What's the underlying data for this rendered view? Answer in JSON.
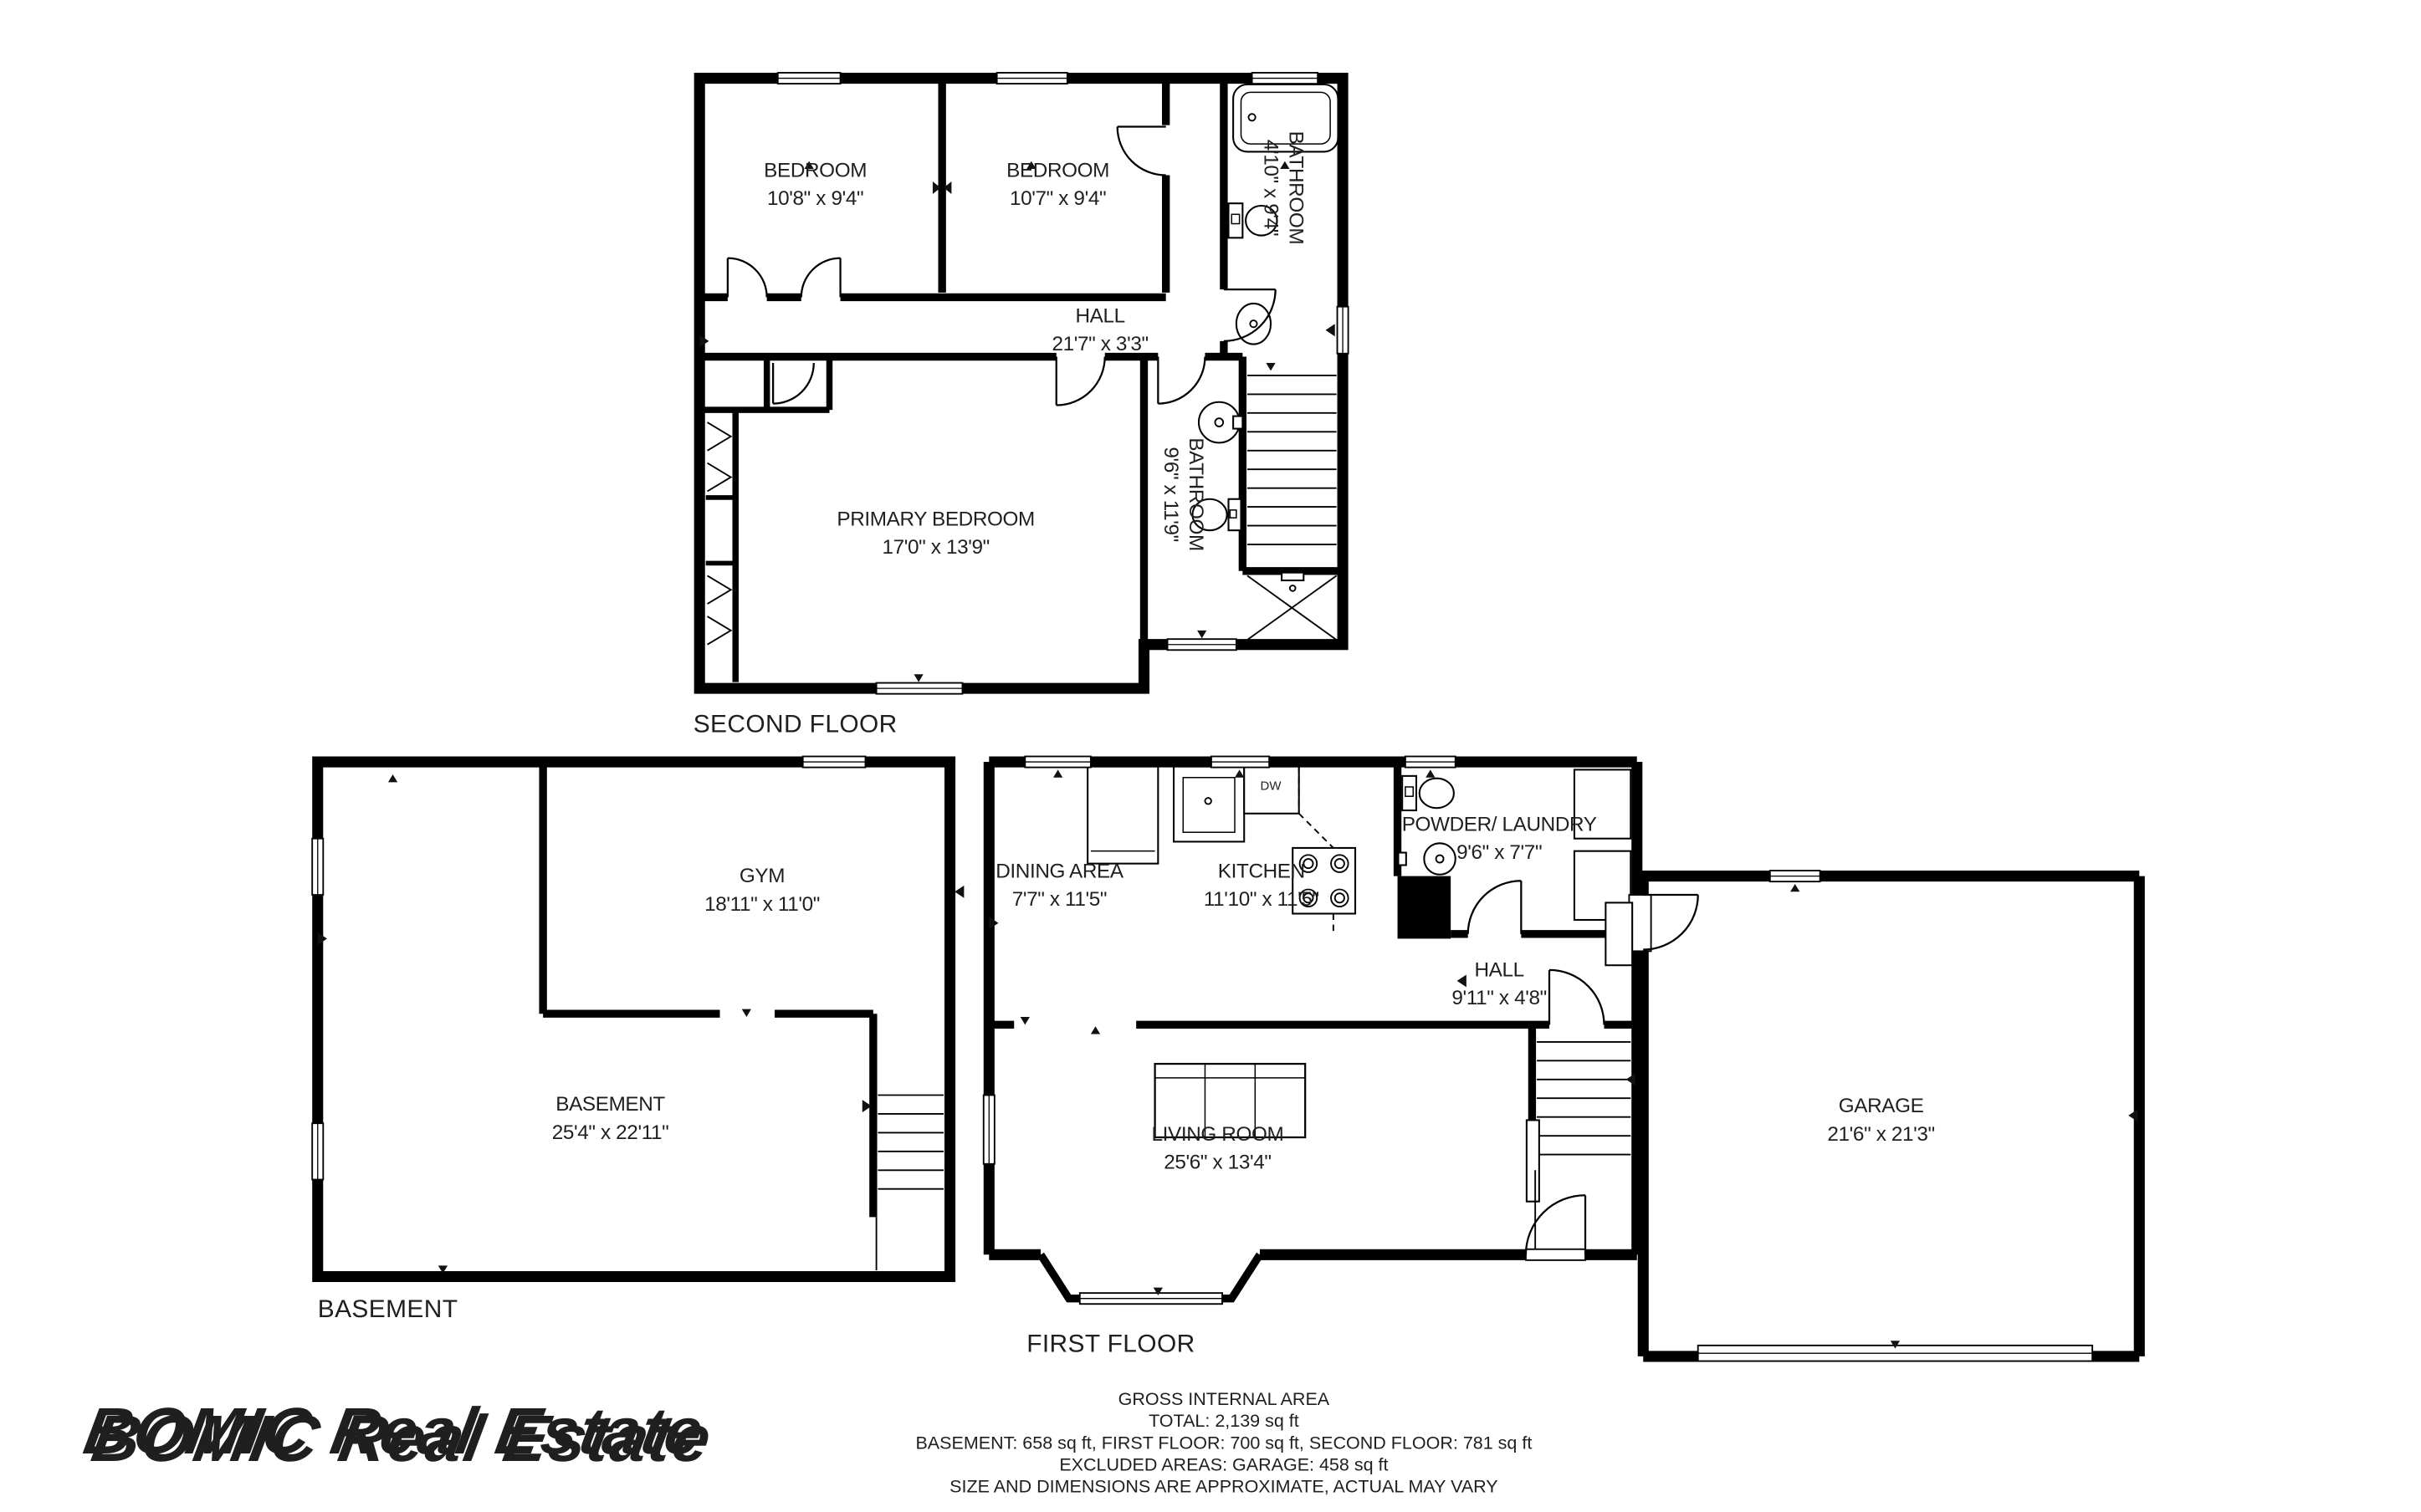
{
  "colors": {
    "wall": "#000000",
    "text": "#1f1f1f",
    "muted": "#a6a6a6",
    "watermark": "#c9c9c9",
    "watermark_highlight": "#ffffff"
  },
  "watermark": {
    "text": "BOMIC Real Estate"
  },
  "floors": {
    "second": {
      "title": "SECOND FLOOR",
      "rooms": {
        "bedroom_left": {
          "name": "BEDROOM",
          "dims": "10'8\" x 9'4\""
        },
        "bedroom_right": {
          "name": "BEDROOM",
          "dims": "10'7\" x 9'4\""
        },
        "bathroom_small": {
          "name": "BATHROOM",
          "dims": "4'10\" x 9'4\""
        },
        "hall": {
          "name": "HALL",
          "dims": "21'7\" x 3'3\""
        },
        "primary_bedroom": {
          "name": "PRIMARY BEDROOM",
          "dims": "17'0\" x 13'9\""
        },
        "bathroom_large": {
          "name": "BATHROOM",
          "dims": "9'6\" x 11'9\""
        }
      }
    },
    "first": {
      "title": "FIRST FLOOR",
      "appliances": {
        "dishwasher": "DW"
      },
      "rooms": {
        "dining_area": {
          "name": "DINING AREA",
          "dims": "7'7\" x 11'5\""
        },
        "kitchen": {
          "name": "KITCHEN",
          "dims": "11'10\" x 11'5\""
        },
        "powder_laundry": {
          "name": "POWDER/ LAUNDRY",
          "dims": "9'6\" x 7'7\""
        },
        "hall": {
          "name": "HALL",
          "dims": "9'11\" x 4'8\""
        },
        "living_room": {
          "name": "LIVING ROOM",
          "dims": "25'6\" x 13'4\""
        },
        "garage": {
          "name": "GARAGE",
          "dims": "21'6\" x 21'3\""
        }
      }
    },
    "basement": {
      "title": "BASEMENT",
      "rooms": {
        "gym": {
          "name": "GYM",
          "dims": "18'11\" x 11'0\""
        },
        "basement_room": {
          "name": "BASEMENT",
          "dims": "25'4\" x 22'11\""
        }
      }
    }
  },
  "footer": {
    "line1": "GROSS INTERNAL AREA",
    "line2": "TOTAL: 2,139 sq ft",
    "line3": "BASEMENT: 658 sq ft, FIRST FLOOR: 700 sq ft, SECOND FLOOR: 781 sq ft",
    "line4": "EXCLUDED AREAS: GARAGE: 458 sq ft",
    "line5": "SIZE AND DIMENSIONS ARE APPROXIMATE, ACTUAL MAY VARY"
  }
}
